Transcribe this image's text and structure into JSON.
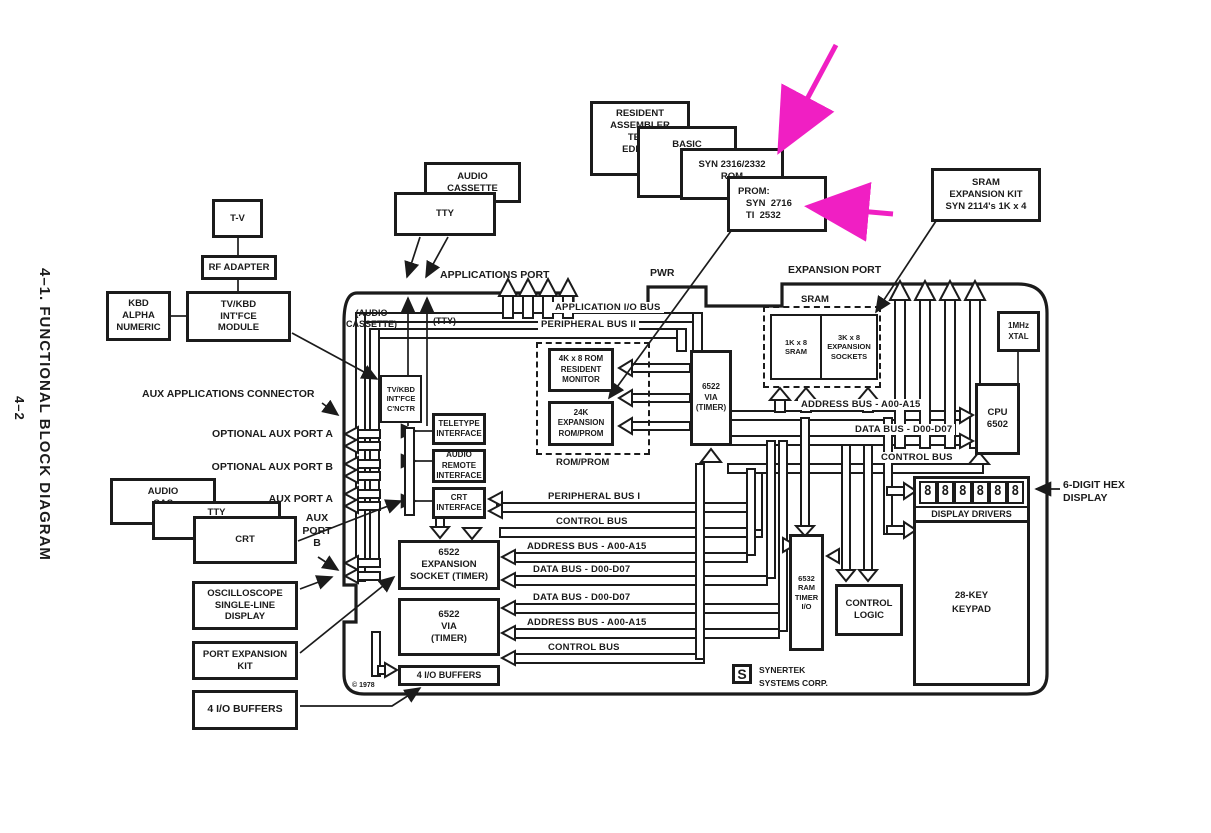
{
  "colors": {
    "ink": "#1b1b1b",
    "magenta": "#f01fc3",
    "background": "#ffffff"
  },
  "page": {
    "side_title": "4–1.  FUNCTIONAL BLOCK DIAGRAM",
    "page_number": "4–2",
    "copyright": "© 1978"
  },
  "peripherals": {
    "tv": "T-V",
    "rf_adapter": "RF ADAPTER",
    "kbd": "KBD\nALPHA\nNUMERIC",
    "tv_kbd_module": "TV/KBD\nINT'FCE\nMODULE",
    "audio_cassette": "AUDIO\nCASSETTE",
    "tty": "TTY",
    "audio_cassette_left": "AUDIO\nCAS",
    "tty_left": "TTY",
    "crt": "CRT",
    "oscilloscope": "OSCILLOSCOPE\nSINGLE-LINE\nDISPLAY",
    "port_expansion_kit": "PORT EXPANSION\nKIT",
    "io_buffers": "4 I/O BUFFERS"
  },
  "firmware": {
    "resident_assembler": "RESIDENT\nASSEMBLER\nTEXT\nEDITOR",
    "basic": "BASIC",
    "rom": "SYN 2316/2332\nROM",
    "prom": "PROM:\n   SYN  2716\n   TI  2532",
    "sram_kit": "SRAM\nEXPANSION KIT\nSYN 2114's 1K x 4"
  },
  "ports": {
    "applications": "APPLICATIONS PORT",
    "pwr": "PWR",
    "expansion": "EXPANSION PORT",
    "aux_connector": "AUX APPLICATIONS CONNECTOR",
    "optional_aux_a": "OPTIONAL AUX PORT A",
    "optional_aux_b": "OPTIONAL AUX PORT B",
    "aux_a": "AUX PORT A",
    "aux_b": "AUX\nPORT\nB",
    "audio_cassette_int": "(AUDIO\nCASSETTE)",
    "tty_int": "(TTY)"
  },
  "board": {
    "tv_kbd_cnctr": "TV/KBD\nINT'FCE\nC'NCTR",
    "teletype_if": "TELETYPE\nINTERFACE",
    "audio_remote_if": "AUDIO\nREMOTE\nINTERFACE",
    "crt_if": "CRT\nINTERFACE",
    "rom_monitor": "4K x 8 ROM\nRESIDENT\nMONITOR",
    "rom_expansion": "24K\nEXPANSION\nROM/PROM",
    "rom_prom": "ROM/PROM",
    "via_1": "6522\nVIA\n(TIMER)",
    "sram": "SRAM",
    "sram_1k": "1K x 8\nSRAM",
    "sram_3k": "3K x 8\nEXPANSION\nSOCKETS",
    "xtal": "1MHz\nXTAL",
    "cpu": "CPU\n6502",
    "expansion_socket": "6522\nEXPANSION\nSOCKET (TIMER)",
    "via_2": "6522\nVIA\n(TIMER)",
    "io_buffers": "4 I/O BUFFERS",
    "ram_6532": "6532\nRAM\nTIMER\nI/O",
    "control_logic": "CONTROL\nLOGIC",
    "display_drivers": "DISPLAY DRIVERS",
    "keypad": "28-KEY\nKEYPAD",
    "digit": "8",
    "logo_letter": "S",
    "maker": "SYNERTEK\nSYSTEMS CORP."
  },
  "buses": {
    "application_io": "APPLICATION I/O BUS",
    "peripheral_2": "PERIPHERAL BUS II",
    "peripheral_1": "PERIPHERAL BUS I",
    "address_cpu": "ADDRESS BUS - A00-A15",
    "data_cpu": "DATA BUS - D00-D07",
    "control_cpu": "CONTROL BUS",
    "control_mid": "CONTROL BUS",
    "address_1": "ADDRESS BUS - A00-A15",
    "data_1": "DATA BUS - D00-D07",
    "data_2": "DATA BUS - D00-D07",
    "address_2": "ADDRESS BUS - A00-A15",
    "control_bottom": "CONTROL BUS"
  },
  "annotations": {
    "hex_display": "6-DIGIT HEX\nDISPLAY"
  }
}
